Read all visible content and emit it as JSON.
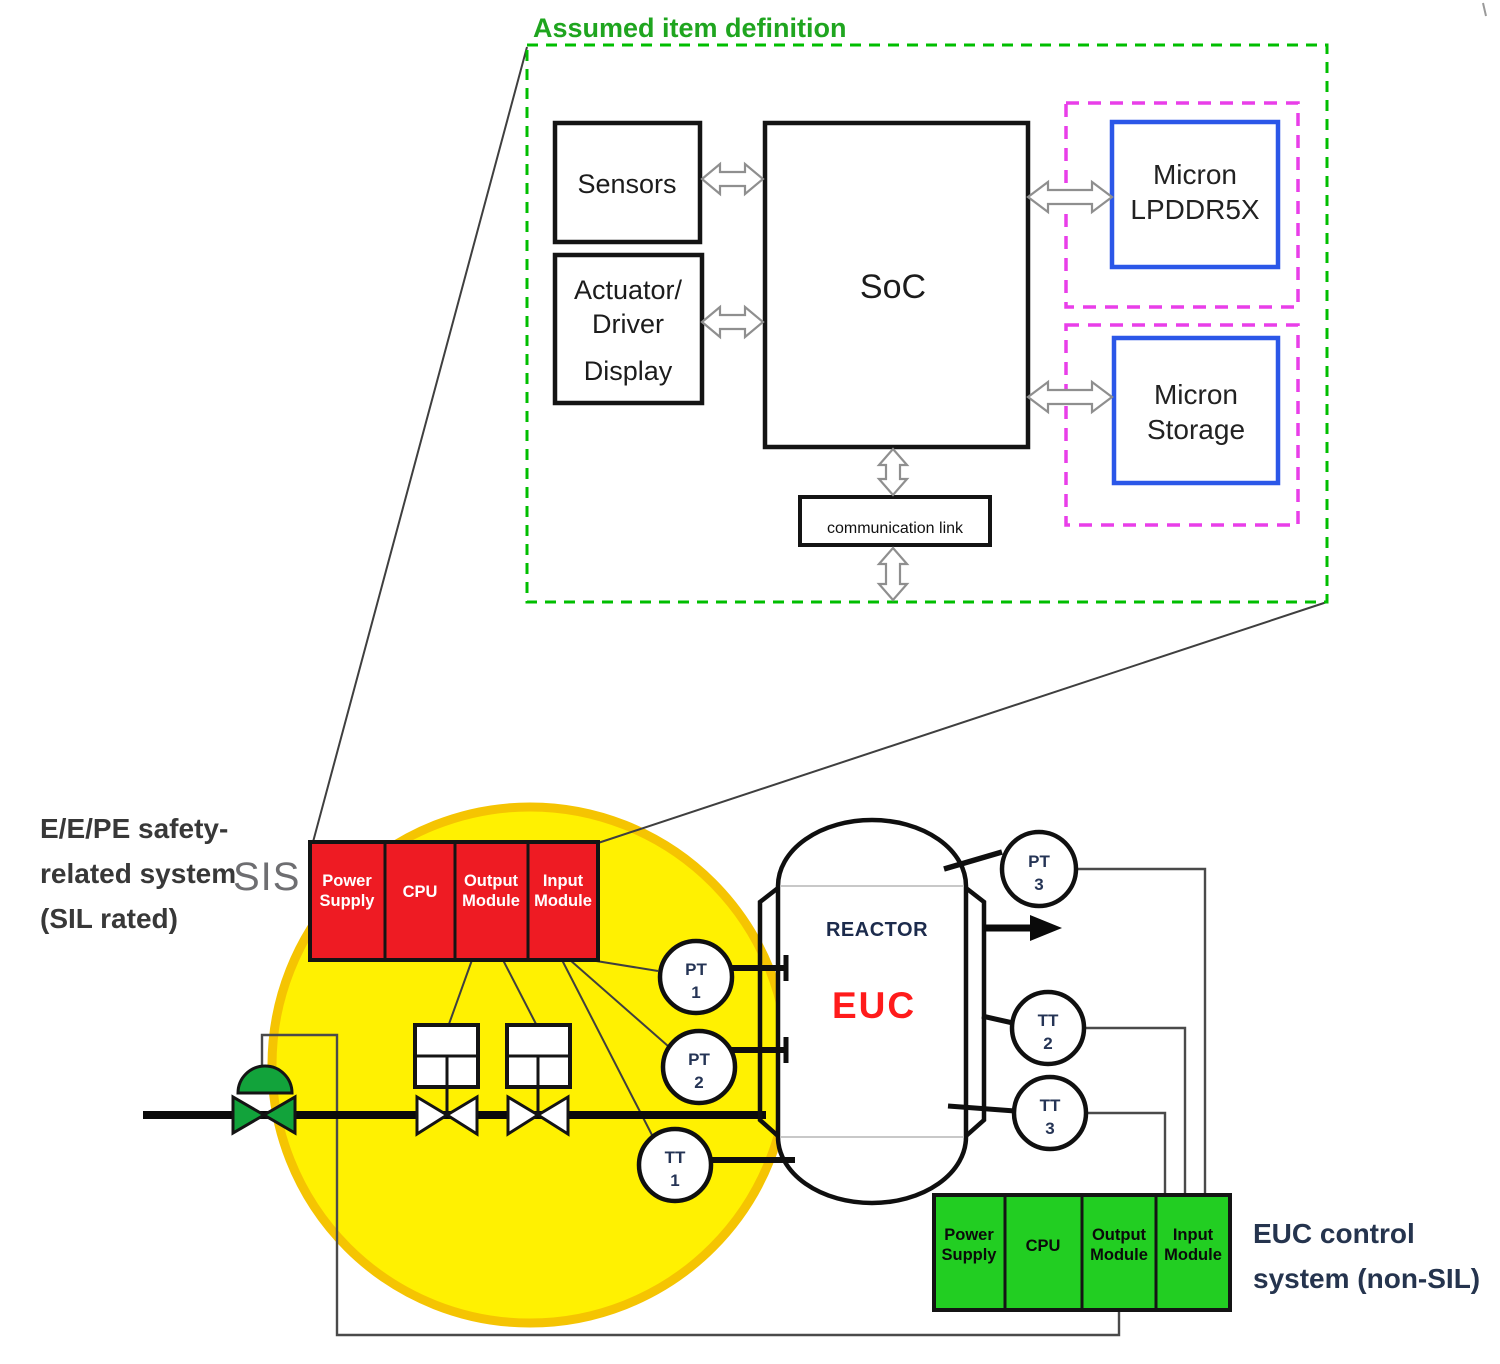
{
  "colors": {
    "title_green": "#1fa51f",
    "dashed_green": "#00be00",
    "dashed_magenta": "#e93ee9",
    "blue_border": "#2b57e8",
    "module_red": "#ee1b23",
    "module_green": "#22ce22",
    "sis_circle_fill": "#fff101",
    "sis_circle_rim": "#f5c402",
    "valve_green": "#12a33b",
    "euc_red": "#ff1b1b",
    "navy_text": "#1c2b4c"
  },
  "assumed_item": {
    "title": "Assumed item definition",
    "sensors": "Sensors",
    "actuator": {
      "line1": "Actuator/",
      "line2": "Driver",
      "line3": "Display"
    },
    "soc": "SoC",
    "lpddr5x": {
      "line1": "Micron",
      "line2": "LPDDR5X"
    },
    "storage": {
      "line1": "Micron",
      "line2": "Storage"
    },
    "communication_link": "communication link"
  },
  "sis": {
    "label_line1": "E/E/PE safety-",
    "label_line2": "related system",
    "label_line3": "(SIL rated)",
    "name": "SIS",
    "modules": [
      {
        "line1": "Power",
        "line2": "Supply"
      },
      {
        "line1": "CPU"
      },
      {
        "line1": "Output",
        "line2": "Module"
      },
      {
        "line1": "Input",
        "line2": "Module"
      }
    ]
  },
  "process": {
    "reactor": "REACTOR",
    "euc": "EUC",
    "instruments": {
      "pt1": {
        "line1": "PT",
        "line2": "1"
      },
      "pt2": {
        "line1": "PT",
        "line2": "2"
      },
      "tt1": {
        "line1": "TT",
        "line2": "1"
      },
      "pt3": {
        "line1": "PT",
        "line2": "3"
      },
      "tt2": {
        "line1": "TT",
        "line2": "2"
      },
      "tt3": {
        "line1": "TT",
        "line2": "3"
      }
    }
  },
  "euc_control": {
    "label_line1": "EUC control",
    "label_line2": "system (non-SIL)",
    "modules": [
      {
        "line1": "Power",
        "line2": "Supply"
      },
      {
        "line1": "CPU"
      },
      {
        "line1": "Output",
        "line2": "Module"
      },
      {
        "line1": "Input",
        "line2": "Module"
      }
    ]
  }
}
